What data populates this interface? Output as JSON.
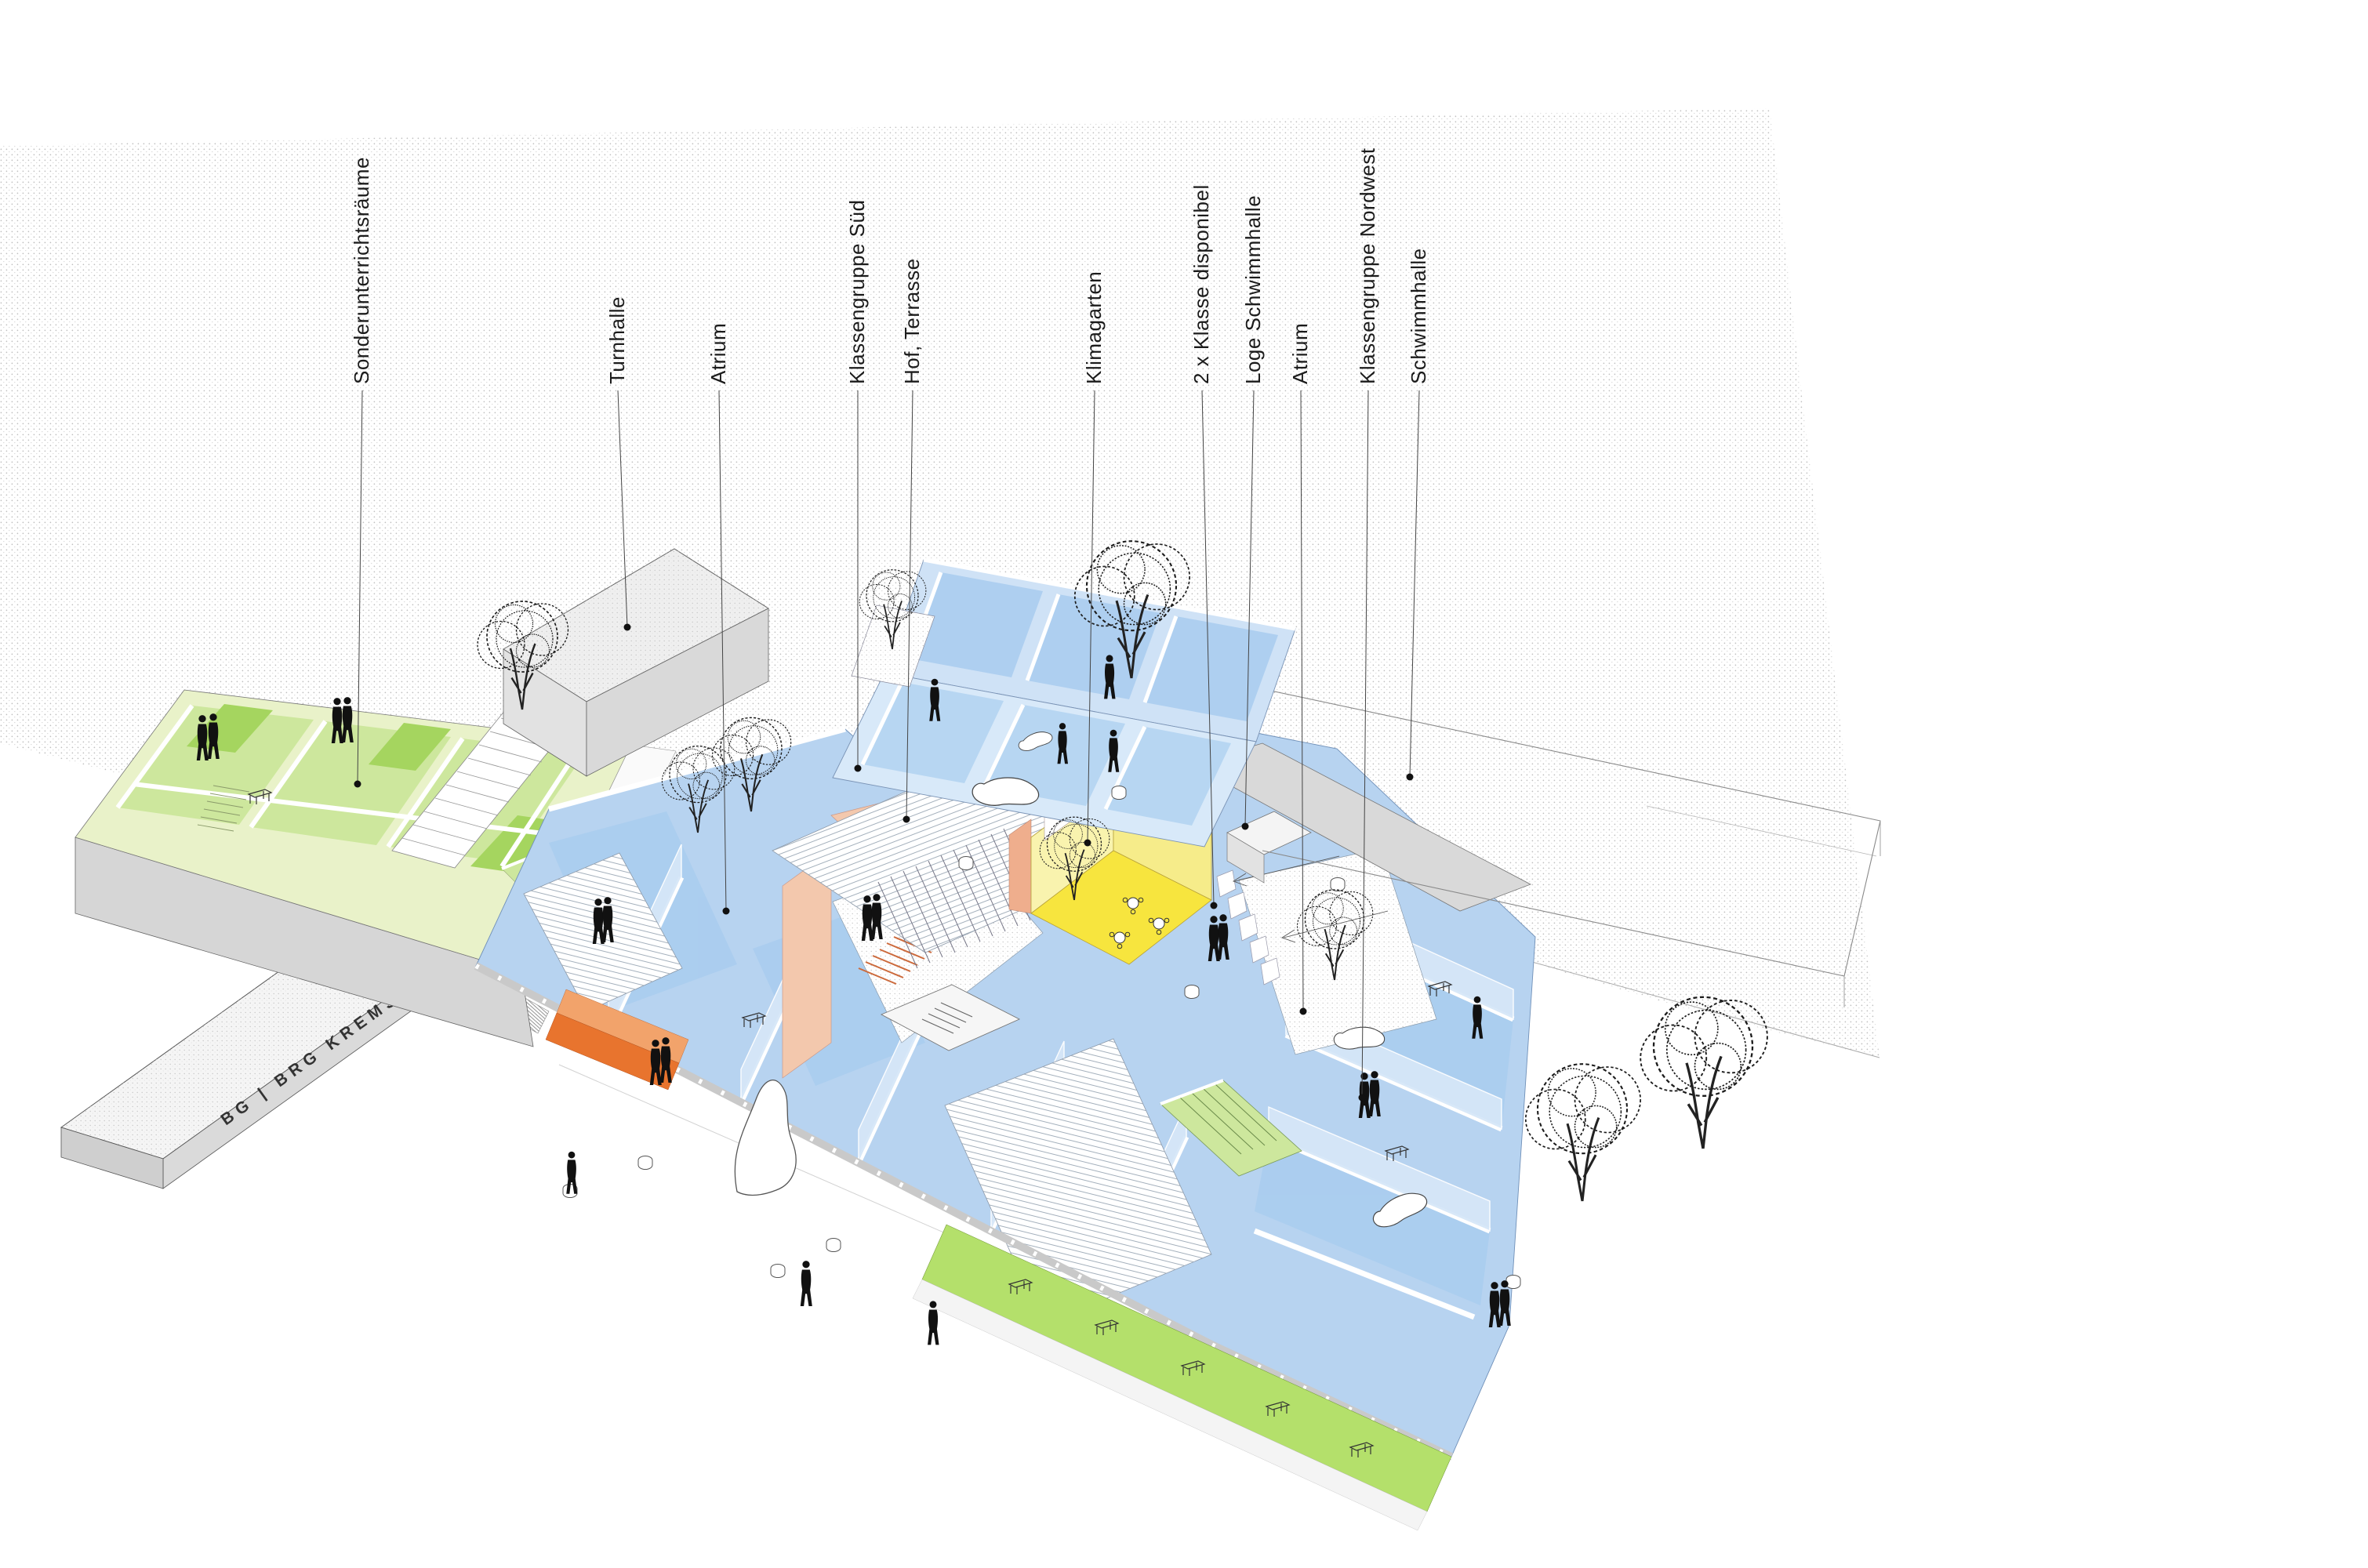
{
  "diagram": {
    "kind": "architectural axonometric floor diagram",
    "building_sign": "BG | BRG KREMS"
  },
  "labels": [
    {
      "text": "Sonderunterrichtsräume"
    },
    {
      "text": "Turnhalle"
    },
    {
      "text": "Atrium"
    },
    {
      "text": "Klassengruppe Süd"
    },
    {
      "text": "Hof, Terrasse"
    },
    {
      "text": "Klimagarten"
    },
    {
      "text": "2 x Klasse disponibel"
    },
    {
      "text": "Loge Schwimmhalle"
    },
    {
      "text": "Atrium"
    },
    {
      "text": "Klassengruppe Nordwest"
    },
    {
      "text": "Schwimmhalle"
    }
  ],
  "colors": {
    "classroom_blue": "#b7d3f0",
    "classroom_blue_wall": "#d6e7f8",
    "special_rooms_green": "#cde79d",
    "special_rooms_green_wall": "#e9f2c9",
    "bright_green": "#a5d55f",
    "front_terrace_green": "#b4e06b",
    "klimagarten_yellow": "#f7e53e",
    "klimagarten_yellow_wall": "#f9f3ae",
    "courtyard_salmon": "#f3c8ad",
    "accent_orange": "#e8742e",
    "structure_gray": "#d9d9d9",
    "ink": "#1c1c1c"
  }
}
